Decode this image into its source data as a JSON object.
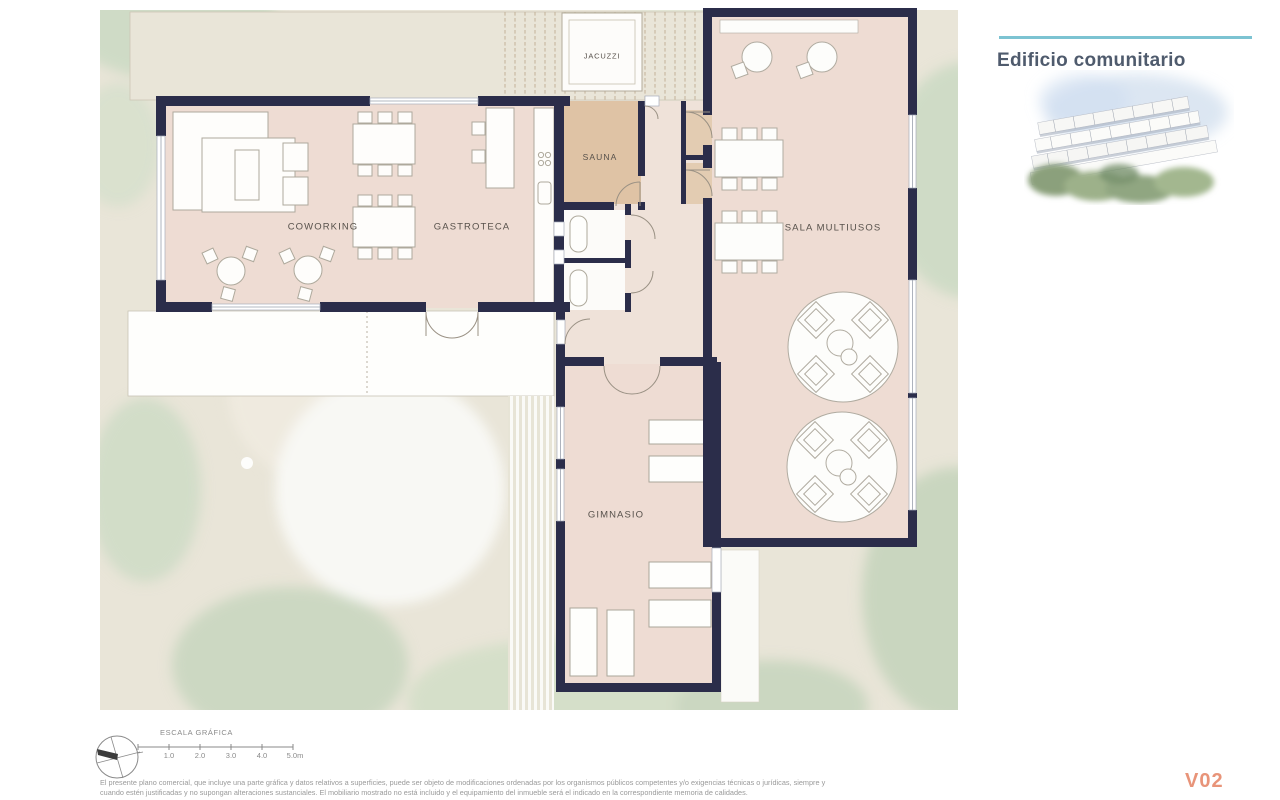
{
  "panel": {
    "title": "Edificio comunitario"
  },
  "plan": {
    "rooms": {
      "jacuzzi": "JACUZZI",
      "sauna": "SAUNA",
      "coworking": "COWORKING",
      "gastroteca": "GASTROTECA",
      "sala_multiusos": "SALA MULTIUSOS",
      "gimnasio": "GIMNASIO"
    }
  },
  "scale_bar": {
    "title": "ESCALA GRÁFICA",
    "ticks": [
      "1.0",
      "2.0",
      "3.0",
      "4.0",
      "5.0m"
    ]
  },
  "footer": {
    "disclaimer_line1": "El presente plano comercial, que incluye una parte gráfica y datos relativos a superficies, puede ser objeto de modificaciones ordenadas por los organismos públicos competentes y/o exigencias técnicas o jurídicas, siempre y",
    "disclaimer_line2": "cuando estén justificadas y no supongan alteraciones sustanciales. El mobiliario mostrado no está incluido y el equipamiento del inmueble será el indicado en la correspondiente memoria de calidades.",
    "version": "V02"
  },
  "colors": {
    "wall": "#2b2d4a",
    "room_fill": "#eedcd3",
    "sauna_fill": "#dfc3a5",
    "site_fill": "#e9e5d8",
    "green_fill": "#cfdbc6",
    "accent_teal": "#7cc3d2",
    "title_color": "#4f5b6d",
    "version_color": "#e89479"
  }
}
